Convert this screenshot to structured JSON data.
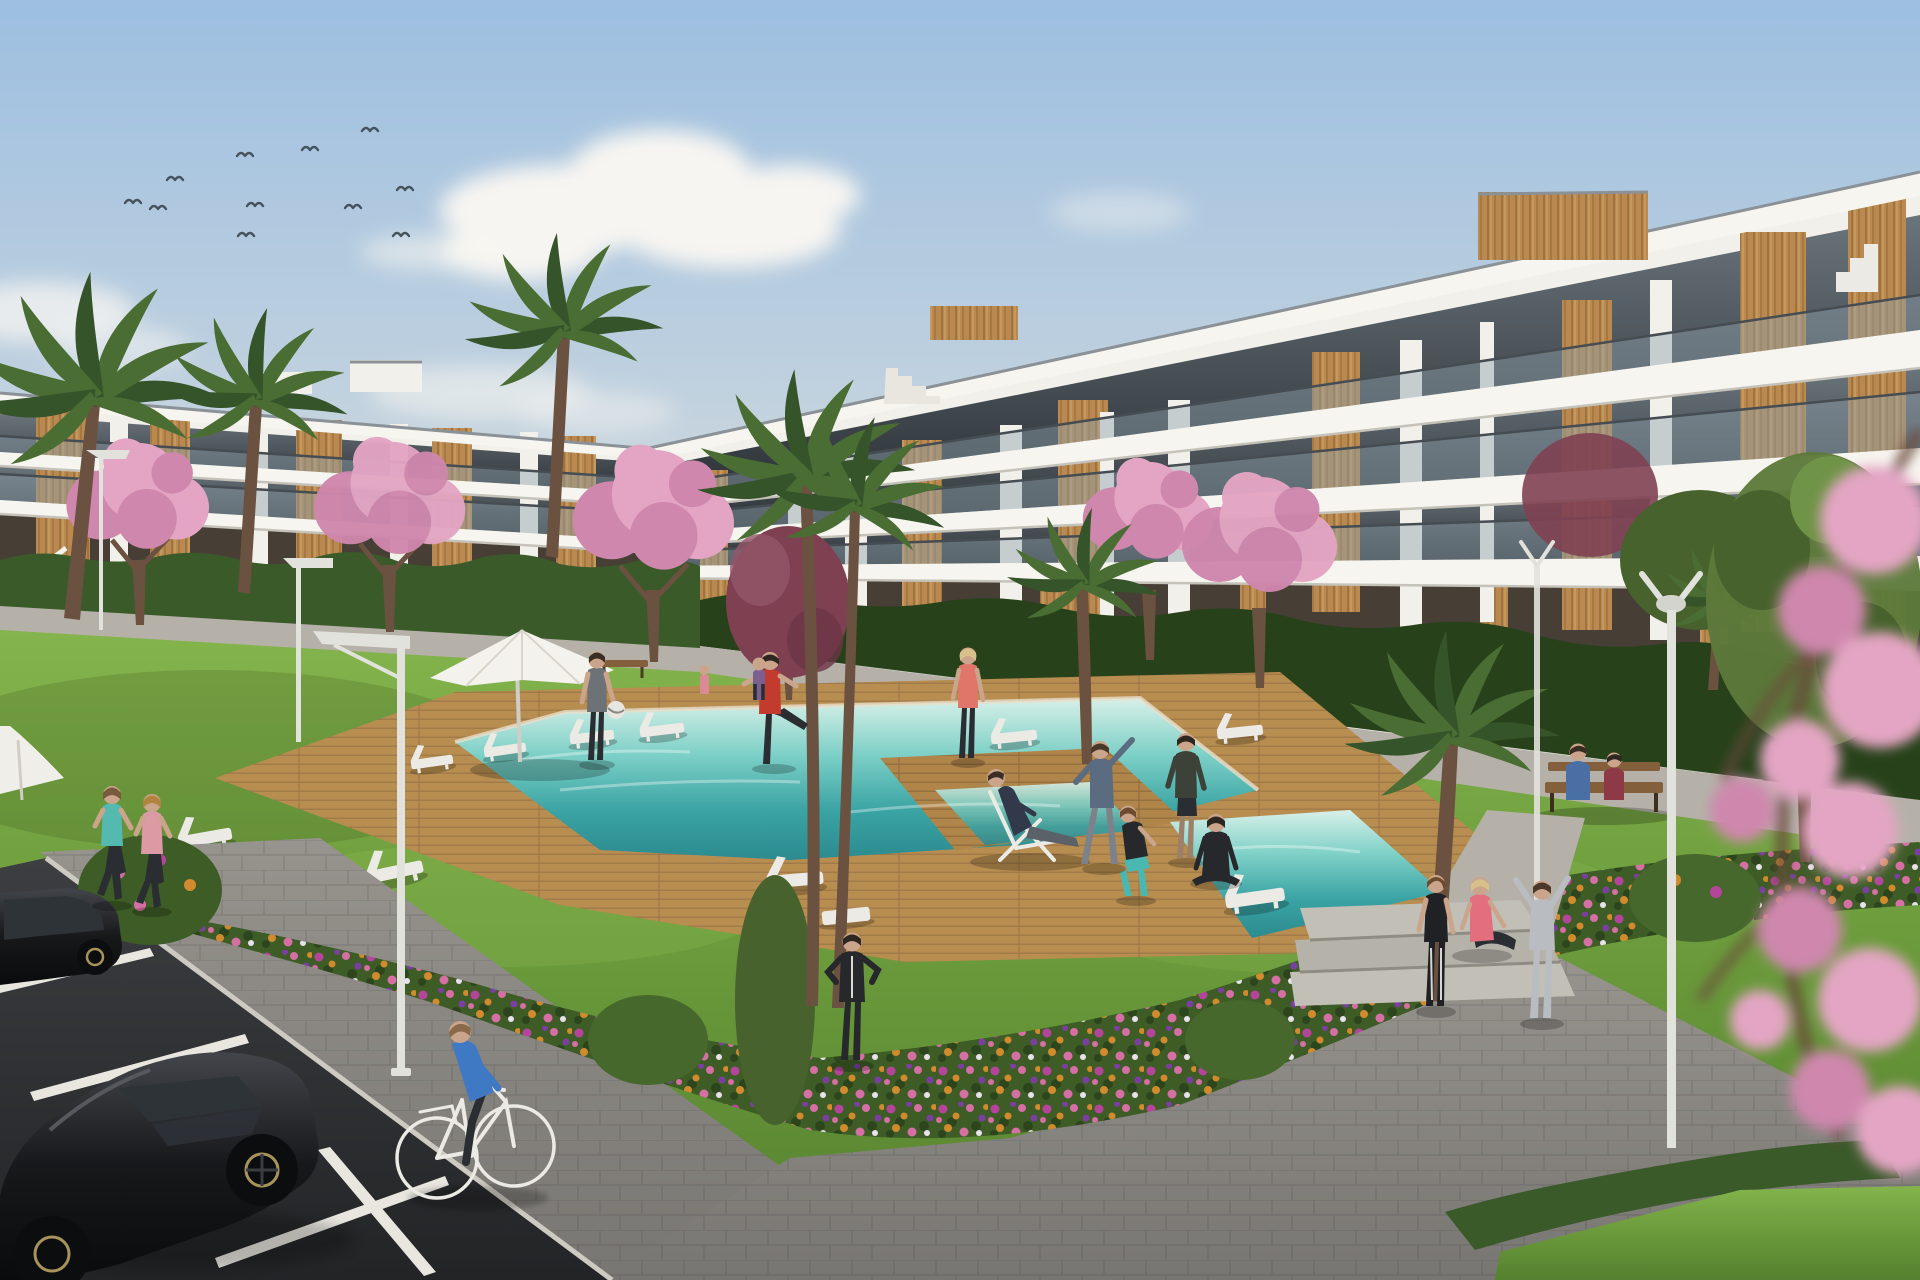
{
  "scene": {
    "caption": "Sunny 3D architectural rendering of a modern white apartment complex: two- and three-storey blocks with wood-clad accents and glass balconies, a turquoise pool with wooden deck and white sun loungers, residents exercising on a lawn, colorful flower beds, palm and pink cherry-blossom trees, street lamps, a paved walkway with a cyclist and joggers, and a parking area with two black cars.",
    "setting_label": "residential-complex-garden-and-pool",
    "time_of_day_label": "late-afternoon-sun",
    "weather_label": "clear-blue-sky-with-scattered-clouds"
  },
  "palette": {
    "skyTop": "#9dbfe0",
    "skyMid": "#bccfdf",
    "skyLow": "#d9dedd",
    "horizon": "#e8e5dd",
    "cloud": "#f7f5f1",
    "bird": "#46525c",
    "buildingWhite": "#f2f0ea",
    "slabWhite": "#f7f5f0",
    "coping": "#8a9197",
    "glassTop": "#6a747b",
    "glassBottom": "#2c3237",
    "balustrade": "#90a2ac",
    "railDark": "#454c52",
    "wood": "#b9894f",
    "woodDark": "#8a6134",
    "woodLight": "#d2a768",
    "groundFloor": "#473f36",
    "hedge": "#3a5a2a",
    "hedgeDark": "#27421a",
    "lawnLight": "#84b44c",
    "lawn": "#6a9a3b",
    "lawnDark": "#55802f",
    "deck": "#b08549",
    "deckDark": "#8f6a3e",
    "deckLight": "#caa268",
    "poolLight": "#d8f0e8",
    "poolMid": "#7dd0c7",
    "poolDeep": "#3aa3a3",
    "poolDeepest": "#2c8b90",
    "pathGray": "#b5b1a8",
    "paver": "#97948e",
    "paverDark": "#787672",
    "asphalt": "#3c3e41",
    "asphaltDark": "#232426",
    "lineWhite": "#e8e6df",
    "carBlack": "#17181a",
    "carHighlight": "#42454a",
    "carGlass": "#2e3338",
    "wheelDark": "#0c0d0f",
    "rimGold": "#a8935a",
    "trunk": "#6b5140",
    "palm": "#4a6d33",
    "palmDark": "#35542a",
    "blossom": "#e3a5c3",
    "blossomDeep": "#cf87ad",
    "plum": "#7f4152",
    "treeGreen": "#5d7a3a",
    "treeGreenDark": "#47622c",
    "bedGreen": "#3d5c26",
    "flowerMagenta": "#b5449b",
    "flowerPink": "#d56fa4",
    "flowerOrange": "#d18a2e",
    "flowerPurple": "#7a3fa0",
    "flowerWhite": "#e9e2ec",
    "lamp": "#e2e2dc",
    "furnitureWhite": "#eceae5",
    "benchWood": "#845f3c",
    "skin": "#caa58b",
    "pantsDark": "#2a2d31",
    "tealTop": "#54b9ae",
    "pinkTop": "#dc9aa4",
    "blueShirt": "#3f79c4",
    "redTop": "#c23b2e",
    "salmonTop": "#e0756a",
    "slateTop": "#5b6b80",
    "grayTrack": "#b9bcc0",
    "blackTrack": "#26282c",
    "benchBlue": "#4a6fa5",
    "maroonTop": "#8d3a46",
    "grayTop": "#6d7277",
    "oliveTop": "#3c4238",
    "tealLeggings": "#49b8b0"
  },
  "inventory": {
    "sky": {
      "birds_count": 11,
      "cloud_clusters": 4
    },
    "buildings": [
      {
        "name": "left-apartment-block",
        "storeys_visible": 2,
        "facade_color": "#f2f0ea",
        "accents": "wood panels, tinted glass, glass balustrades, external stair"
      },
      {
        "name": "right-apartment-block",
        "storeys_visible": 3,
        "facade_color": "#f2f0ea",
        "accents": "wood towers, rooftop terraces, stepped parapets, glass balconies"
      }
    ],
    "pool": {
      "water_color": "turquoise",
      "deck_material": "wood planks",
      "sun_loungers": 11,
      "deck_chairs": 1,
      "parasols": 2
    },
    "vegetation": {
      "palm_trees": 7,
      "cherry_blossom_trees": 5,
      "purple_leaf_trees": 2,
      "green_trees": 2,
      "hedges": "along building bases and lower-right path",
      "flower_colors": [
        "magenta",
        "pink",
        "orange",
        "purple",
        "white"
      ]
    },
    "people": [
      {
        "label": "jogger",
        "top_color": "#54b9ae"
      },
      {
        "label": "jogger",
        "top_color": "#dc9aa4"
      },
      {
        "label": "cyclist",
        "top_color": "#3f79c4"
      },
      {
        "label": "man-holding-ball",
        "top_color": "#6d7277"
      },
      {
        "label": "man-stretching-leg",
        "top_color": "#c23b2e"
      },
      {
        "label": "woman-standing",
        "top_color": "#e0756a"
      },
      {
        "label": "man-on-deck-chair",
        "top_color": "#31394a"
      },
      {
        "label": "woman-squatting",
        "leggings_color": "#49b8b0"
      },
      {
        "label": "person-black-tracksuit",
        "top_color": "#26282c"
      },
      {
        "label": "person-side-stretch-arm-up",
        "top_color": "#5b6b80"
      },
      {
        "label": "man-standing",
        "top_color": "#3c4238"
      },
      {
        "label": "woman-seated-yoga",
        "top_color": "#26282c"
      },
      {
        "label": "woman-standing-by-steps",
        "top_color": "#1f2125"
      },
      {
        "label": "woman-sitting-on-steps",
        "top_color": "#e26e7e"
      },
      {
        "label": "person-stretching-gray",
        "top_color": "#b9bcc0"
      },
      {
        "label": "bench-sitter",
        "top_color": "#4a6fa5"
      },
      {
        "label": "bench-sitter",
        "top_color": "#8d3a46"
      },
      {
        "label": "walker-back-path",
        "top_color": "#7b5f8f"
      },
      {
        "label": "child-back-path",
        "top_color": "#d98a95"
      }
    ],
    "vehicles": [
      {
        "label": "parked-black-car",
        "color": "#17181a"
      },
      {
        "label": "parked-black-car",
        "color": "#17181a"
      },
      {
        "label": "bicycle",
        "color": "#ececea"
      }
    ],
    "street_furniture": {
      "street_lamps": 5,
      "benches": 2,
      "parking_stripes": 4,
      "steps": 3
    }
  }
}
